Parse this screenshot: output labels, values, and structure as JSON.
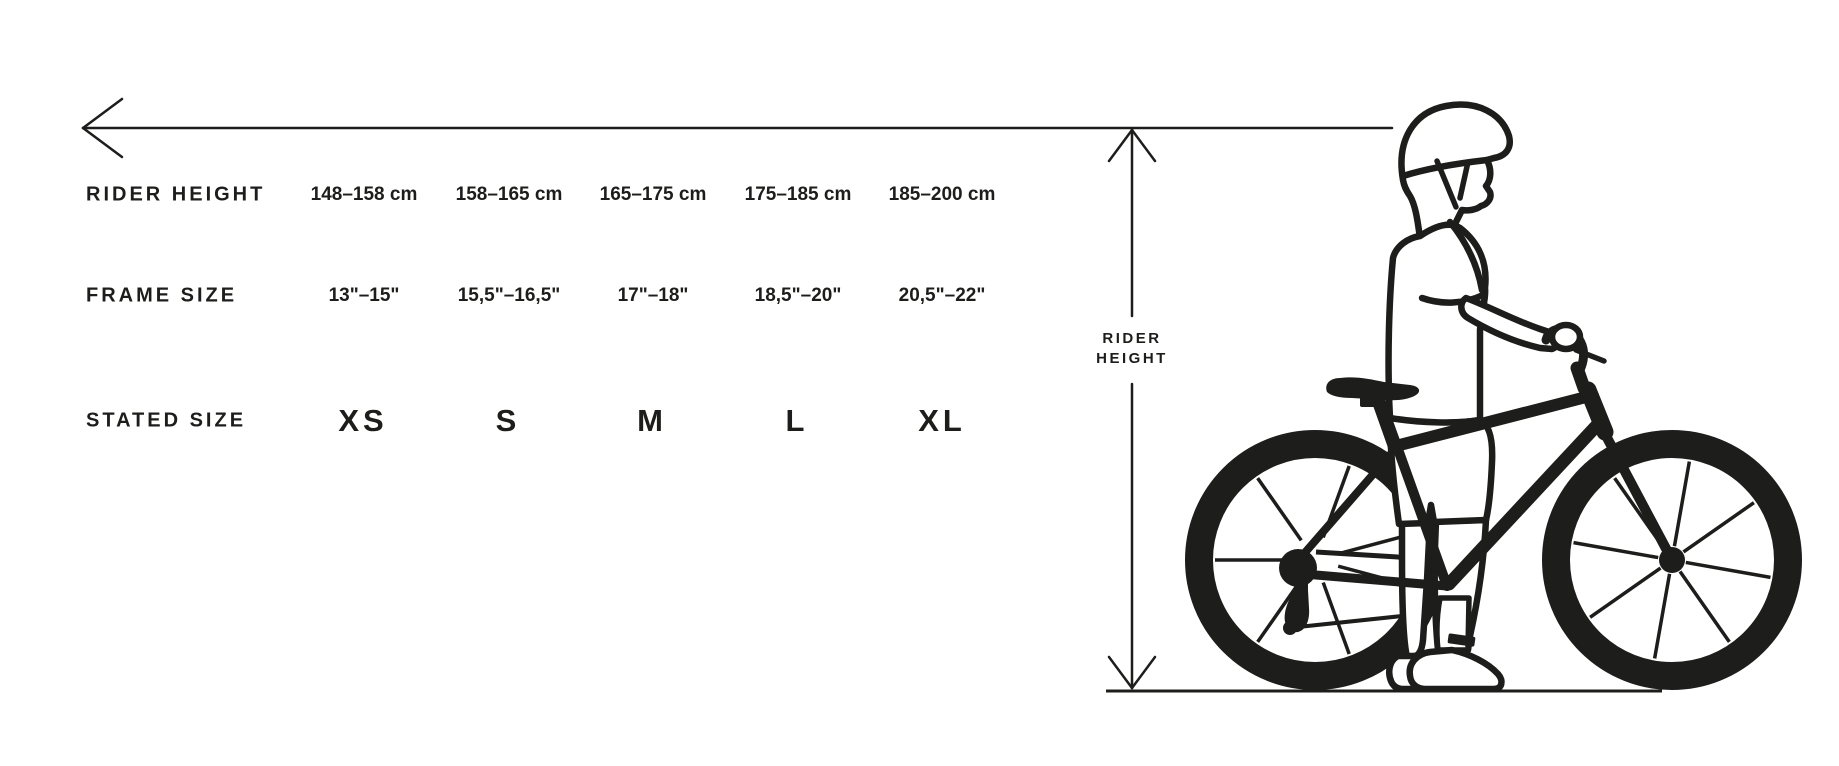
{
  "ink_color": "#1d1d1b",
  "measure": {
    "label_line1": "RIDER",
    "label_line2": "HEIGHT"
  },
  "table": {
    "rows": [
      {
        "label": "RIDER HEIGHT",
        "values": [
          "148–158 cm",
          "158–165 cm",
          "165–175 cm",
          "175–185 cm",
          "185–200 cm"
        ]
      },
      {
        "label": "FRAME SIZE",
        "values": [
          "13\"–15\"",
          "15,5\"–16,5\"",
          "17\"–18\"",
          "18,5\"–20\"",
          "20,5\"–22\""
        ]
      },
      {
        "label": "STATED SIZE",
        "values": [
          "XS",
          "S",
          "M",
          "L",
          "XL"
        ]
      }
    ]
  },
  "illustration": {
    "description": "rider standing with mountain bike"
  }
}
